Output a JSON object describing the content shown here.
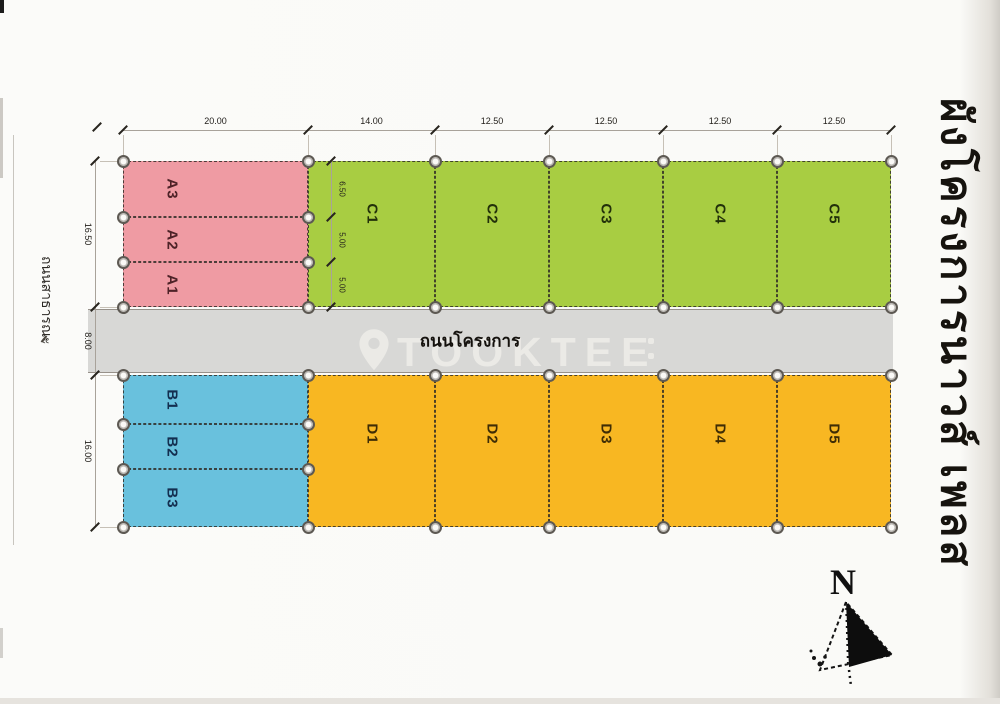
{
  "title_vertical": "ผังโครงการนาวส์ เพลส",
  "left_road_label": "ถนนสาธารณะ",
  "road": {
    "label": "ถนนโครงการ",
    "color": "#d8d8d6"
  },
  "watermark": {
    "text": "TOOKTEE",
    "icon": "location-pin-icon"
  },
  "compass": {
    "north_label": "N"
  },
  "dimensions": {
    "top": [
      "20.00",
      "14.00",
      "12.50",
      "12.50",
      "12.50",
      "12.50"
    ],
    "left": [
      "16.50",
      "8.00",
      "16.00"
    ],
    "inner_rows": [
      "6.50",
      "5.00",
      "5.00"
    ]
  },
  "plots": {
    "pink": {
      "color": "#ef9ba3",
      "label_color": "#4d2227",
      "labels": [
        "A3",
        "A2",
        "A1"
      ]
    },
    "green": {
      "color": "#a8cd42",
      "label_color": "#22300a",
      "labels": [
        "C1",
        "C2",
        "C3",
        "C4",
        "C5"
      ]
    },
    "blue": {
      "color": "#69c1dd",
      "label_color": "#132e4f",
      "labels": [
        "B1",
        "B2",
        "B3"
      ]
    },
    "orange": {
      "color": "#f8b722",
      "label_color": "#3f2d05",
      "labels": [
        "D1",
        "D2",
        "D3",
        "D4",
        "D5"
      ]
    }
  }
}
